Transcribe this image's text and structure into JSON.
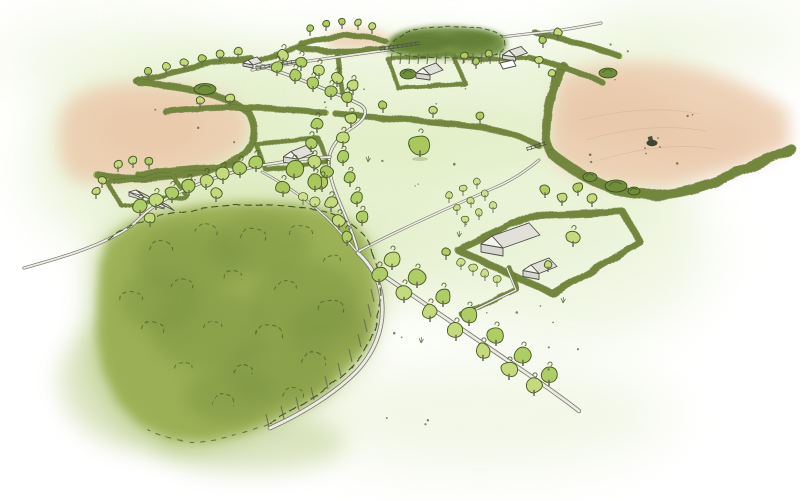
{
  "scene": {
    "title": "Hand-drawn watercolour aerial sketch of a farmed countryside landscape",
    "features": {
      "woodland": "large broadleaf woodland",
      "woodland_block": "small dense tree belt by the north lane",
      "left_arable_field": "bare arable field, top left",
      "right_arable_field": "large bare arable field with tractor",
      "tractor": "tractor working the field",
      "farmstead_main": "farmyard with two barns, orchard and hedged yard",
      "farmstead_mid": "small farmstead with hedged yard",
      "farmstead_nw": "smallholding with sheds",
      "avenue_southeast": "tree-lined lane running south-east",
      "lane_north": "winding tree-lined lane to the north",
      "lane_west": "lane fading out to the west",
      "hedgerows": "hedgerow field boundaries with hedgerow trees",
      "pasture": "pale green pasture fields",
      "fences": "post-and-rail field fences"
    }
  },
  "colors": {
    "paper": "#ffffff",
    "wash": "#e9f2d4",
    "washDeep": "#dcebbc",
    "peach": "#ecceb0",
    "peachDeep": "#e2ba99",
    "woodBase": "#97ad50",
    "woodBleed": "#aabf6c",
    "woodDark": "#7c9440",
    "woodInk": "#3f5523",
    "clump": "#708d3c",
    "clumpDark": "#55702c",
    "clumpInk": "#33491b",
    "hedge": "#a3bd60",
    "hedgeDark": "#5d7030",
    "crownLight": "#c4da7f",
    "crownMid": "#afcd66",
    "crownPale": "#cbdf8e",
    "crownBig": "#a9c75d",
    "treeInk": "#4a5c24",
    "trunk": "#6b6b54",
    "roadDark": "#68685f",
    "roadLight": "#ebebe2",
    "ink": "#51514a",
    "buildingWhite": "#ffffff",
    "buildingGable": "#f4f4ee",
    "buildingRoofShade": "#e1e1da",
    "buildingWall": "#d7d7cf",
    "speck": "#55603a",
    "furrow": "#d6b18e"
  }
}
